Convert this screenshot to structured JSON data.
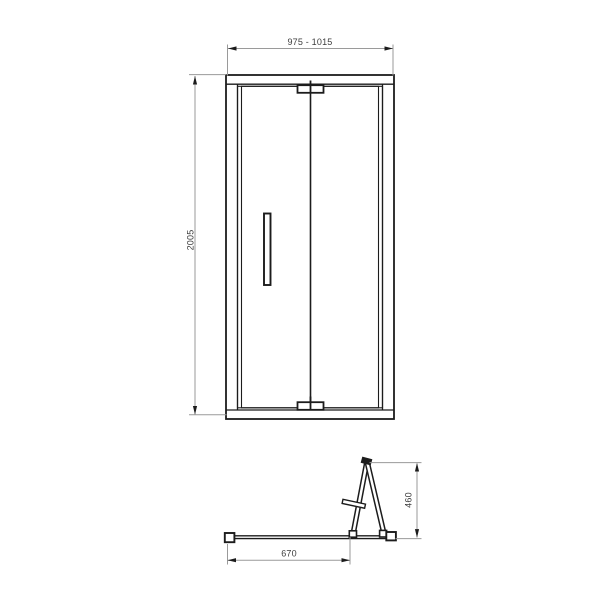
{
  "drawing": {
    "name": "Bi-fold shower door technical drawing",
    "views": {
      "front": {
        "name": "front elevation",
        "dimensions": {
          "width": {
            "label": "975 - 1015"
          },
          "height": {
            "label": "2005"
          }
        }
      },
      "plan": {
        "name": "plan view with door folded open",
        "dimensions": {
          "depth": {
            "label": "460"
          },
          "width": {
            "label": "670"
          }
        }
      }
    },
    "colors": {
      "outline": "#1c1c1c",
      "dimension_line": "#9a9a9a",
      "dimension_text": "#3d3d3d",
      "background": "#ffffff"
    }
  }
}
